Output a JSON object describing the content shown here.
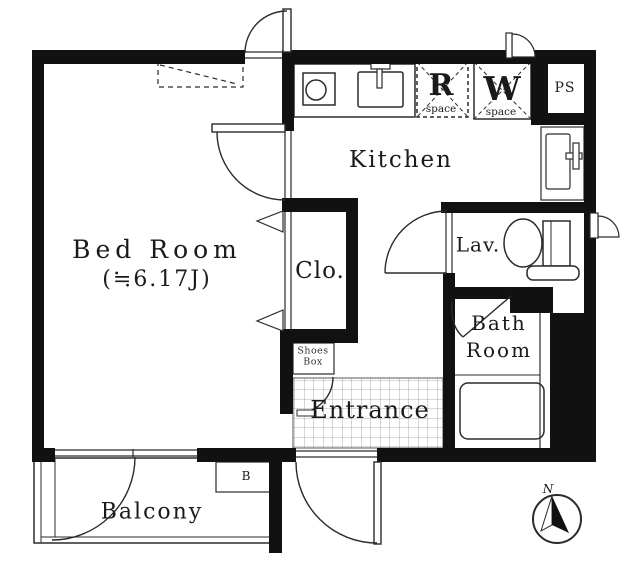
{
  "plan": {
    "rooms": {
      "bedroom": {
        "name": "Bed Room",
        "size": "(≒6.17J)"
      },
      "kitchen": {
        "name": "Kitchen"
      },
      "closet": {
        "name": "Clo."
      },
      "lavatory": {
        "name": "Lav."
      },
      "bathroom": {
        "line1": "Bath",
        "line2": "Room"
      },
      "entrance": {
        "name": "Entrance"
      },
      "balcony": {
        "name": "Balcony"
      }
    },
    "fixtures": {
      "shoes_box": {
        "line1": "Shoes",
        "line2": "Box"
      },
      "refrigerator_space": {
        "letter": "R",
        "caption": "space"
      },
      "washer_space": {
        "letter": "W",
        "caption": "space"
      },
      "pipe_space": {
        "label": "PS"
      },
      "boiler": {
        "label": "B"
      }
    },
    "compass": {
      "north_label": "N"
    },
    "colors": {
      "wall": "#111111",
      "line": "#2b2b2b",
      "tile_grid": "#999999"
    }
  }
}
